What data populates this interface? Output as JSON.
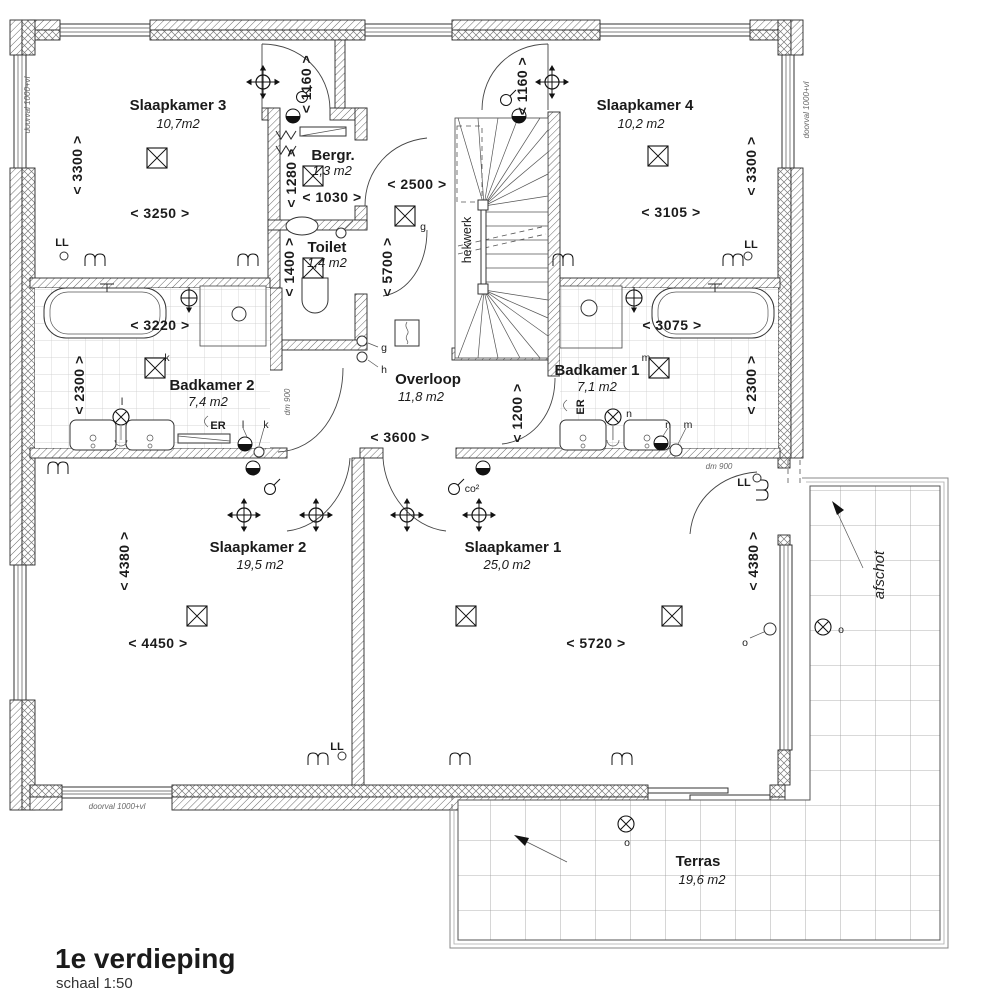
{
  "title": {
    "floor": "1e verdieping",
    "scale": "schaal 1:50"
  },
  "rooms": {
    "s3": {
      "name": "Slaapkamer 3",
      "area": "10,7m2"
    },
    "s4": {
      "name": "Slaapkamer 4",
      "area": "10,2 m2"
    },
    "berg": {
      "name": "Bergr.",
      "area": "1,3 m2"
    },
    "toilet": {
      "name": "Toilet",
      "area": "1,4 m2"
    },
    "overloop": {
      "name": "Overloop",
      "area": "11,8 m2"
    },
    "bk2": {
      "name": "Badkamer 2",
      "area": "7,4 m2"
    },
    "bk1": {
      "name": "Badkamer 1",
      "area": "7,1 m2"
    },
    "s2": {
      "name": "Slaapkamer 2",
      "area": "19,5 m2"
    },
    "s1": {
      "name": "Slaapkamer 1",
      "area": "25,0 m2"
    },
    "terras": {
      "name": "Terras",
      "area": "19,6 m2"
    }
  },
  "dims": {
    "s3w": "< 3250 >",
    "s3h": "< 3300 >",
    "s4w": "< 3105 >",
    "s4h": "< 3300 >",
    "d3": "< 1160 >",
    "d4": "< 1160 >",
    "bergh": "< 1280 >",
    "bergw": "< 1030 >",
    "toih": "< 1400 >",
    "ov_top": "< 2500 >",
    "ov_h": "< 5700 >",
    "ov_w": "< 3600 >",
    "ov_c": "< 1200 >",
    "b2w": "< 3220 >",
    "b2h": "< 2300 >",
    "b1w": "< 3075 >",
    "b1h": "< 2300 >",
    "s2w": "< 4450 >",
    "s2h": "< 4380 >",
    "s1w": "< 5720 >",
    "s1h": "< 4380 >"
  },
  "labels": {
    "hekwerk": "hekwerk",
    "afschot": "afschot",
    "doorval": "doorval 1000+vl",
    "dm900": "dm 900",
    "ll": "LL",
    "er": "ER",
    "co2": "co²",
    "g": "g",
    "h": "h",
    "k": "k",
    "l": "l",
    "m": "m",
    "n": "n",
    "o": "o"
  }
}
